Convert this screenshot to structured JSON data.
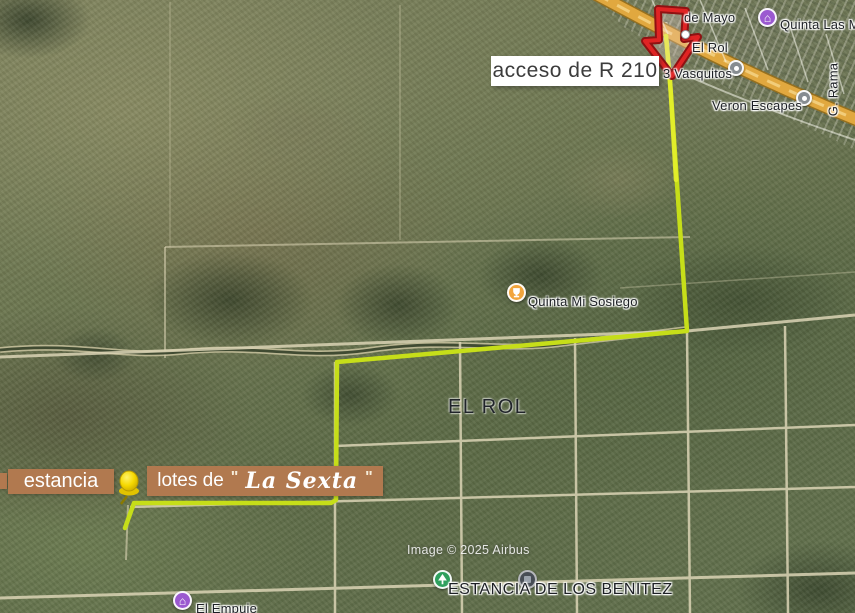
{
  "attribution": "Image © 2025 Airbus",
  "colors": {
    "route": "#c6de19",
    "route_bright": "#e4ef2c",
    "arrow": "#e02424",
    "arrow_dark": "#8f1212",
    "callout_box": "#b1794f",
    "callout_text": "#ffffff",
    "acceso_box": "#ffffff",
    "acceso_text": "#3c3c3c",
    "highway": "#e1a83f",
    "road": "#dbd4b5",
    "creek": "#333f28",
    "marker_gray": "#868c91",
    "marker_orange": "#f2a53c",
    "marker_purple": "#9b59d0",
    "marker_green": "#2fa05e",
    "marker_dark": "#474d55",
    "pushpin": "#f5d800"
  },
  "callouts": {
    "acceso_label": "acceso de R 210",
    "estancia_label": "estancia",
    "lotes_prefix": "lotes de",
    "lotes_open_quote": "\"",
    "lotes_name": "La Sexta",
    "lotes_close_quote": "\""
  },
  "area_labels": {
    "el_rol": "EL ROL"
  },
  "places": {
    "de_mayo": "de Mayo",
    "quinta_las_moras": "Quinta Las Mora",
    "el_rol": "El Rol",
    "tres_vasquitos": "3 Vasquitos",
    "veron_escapes": "Veron Escapes",
    "g_rama": "G. Rama",
    "quinta_mi_sosiego": "Quinta Mi Sosiego",
    "estancia_de_los_benitez": "ESTANCIA DE LOS BENITEZ",
    "el_empuje": "El Empuje"
  },
  "icons": {
    "lodging_glyph": "⌂"
  }
}
